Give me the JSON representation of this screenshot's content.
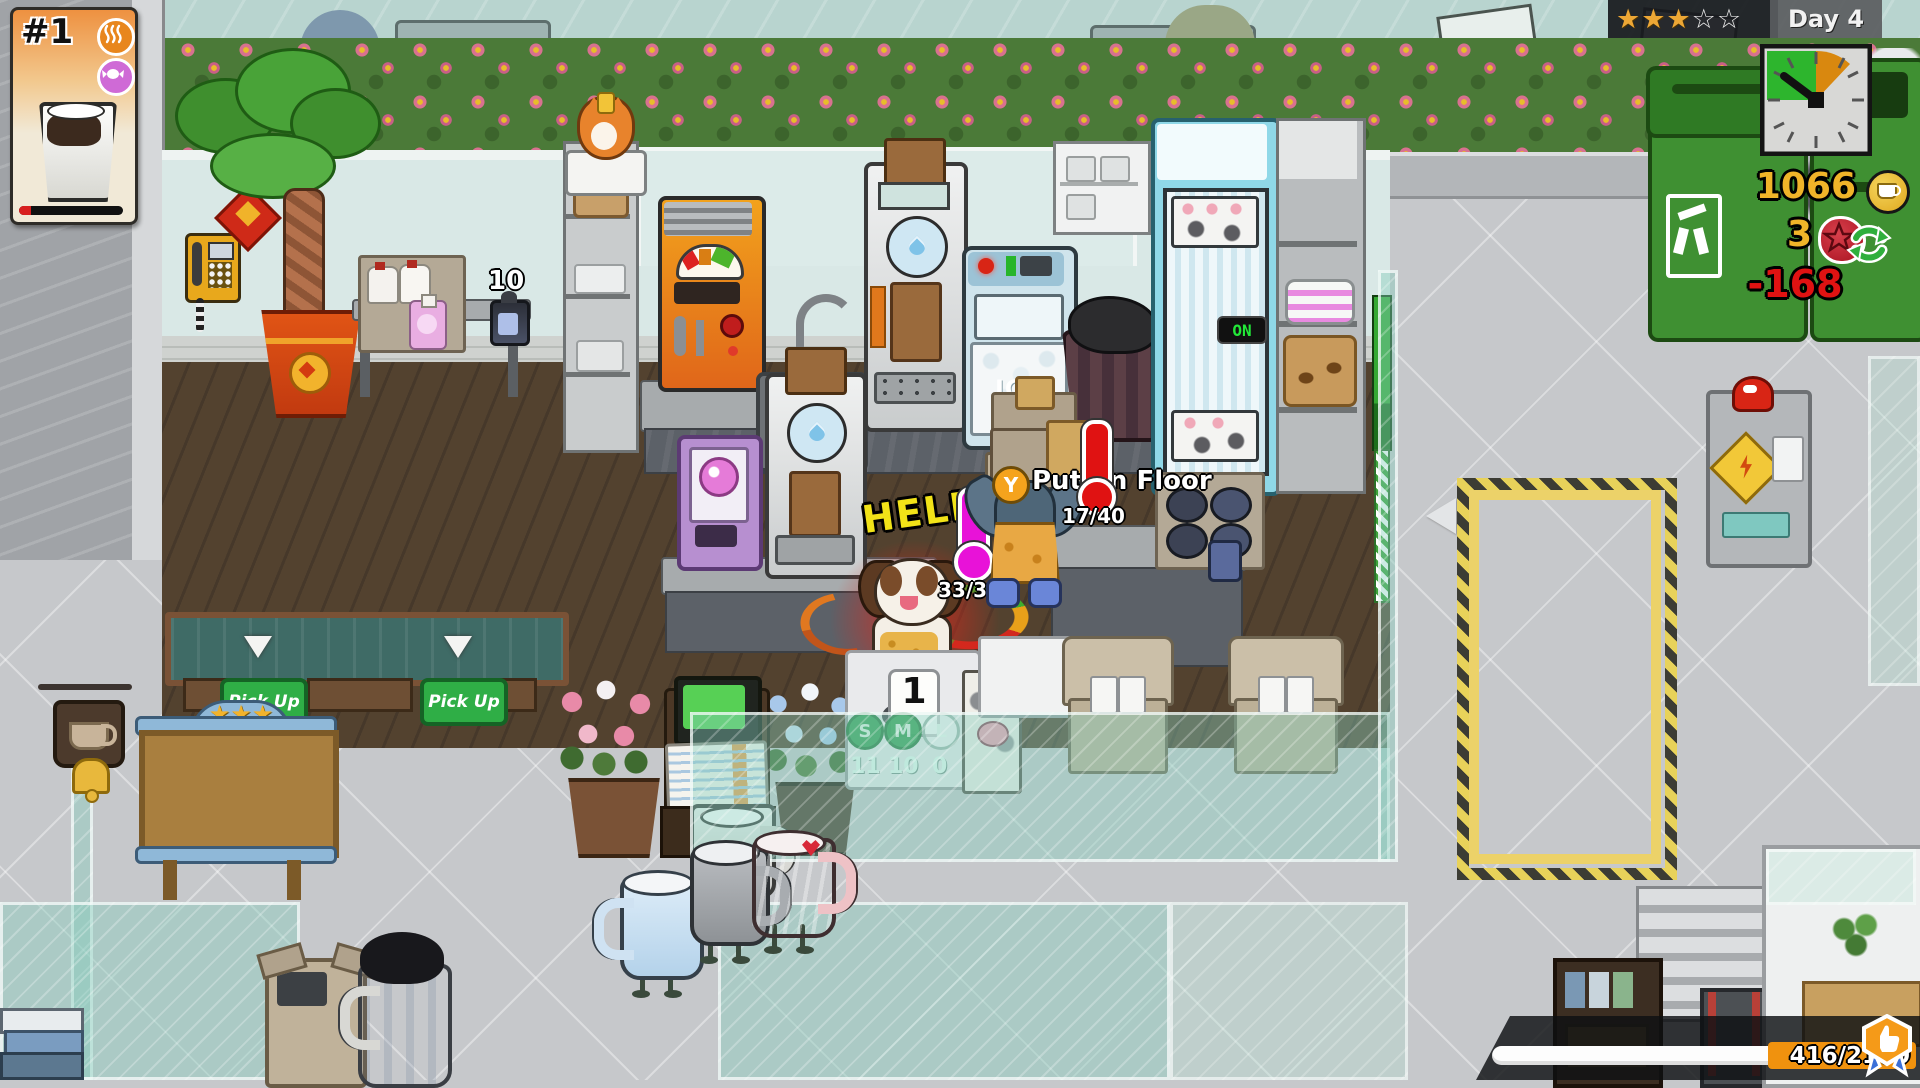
{
  "hud": {
    "order_card": {
      "id": "#1",
      "timer_percent": 12,
      "tags": [
        "hot-drink",
        "sweet"
      ]
    },
    "rating": {
      "stars_filled": "★★★",
      "stars_empty": "☆☆",
      "day_label": "Day 4"
    },
    "resources": {
      "coins": "1066",
      "recycle_count": "3",
      "expense": "-168"
    },
    "xp_progress": "416/2160"
  },
  "world": {
    "help_bubble": "HELP",
    "action_prompt": {
      "button": "Y",
      "label": "Put on Floor"
    },
    "carry_meter": "17/40",
    "heat_meter": "33/32",
    "queue_number": "1",
    "can_stock": "10",
    "fridge_indicator": "ON",
    "ice_machine_label": "ICE",
    "pickup_sign": "Pick Up",
    "cup_stock": [
      {
        "size": "S",
        "count": "11"
      },
      {
        "size": "M",
        "count": "10"
      },
      {
        "size": "L",
        "count": "0"
      }
    ],
    "arch_stars": "★★★"
  }
}
